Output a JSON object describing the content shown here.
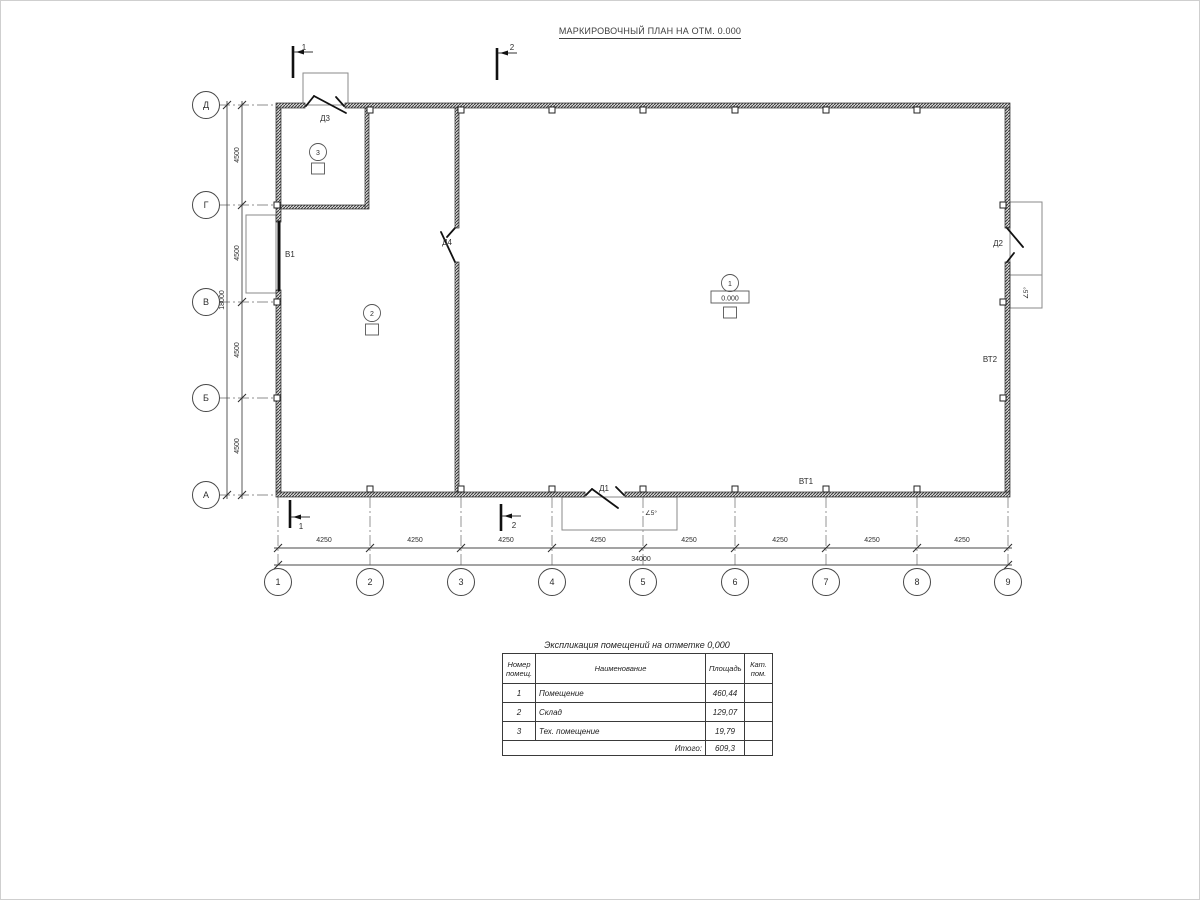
{
  "page": {
    "title": "МАРКИРОВОЧНЫЙ ПЛАН НА ОТМ. 0.000"
  },
  "plan": {
    "axes": {
      "rows": [
        "Д",
        "Г",
        "В",
        "Б",
        "А"
      ],
      "cols": [
        "1",
        "2",
        "3",
        "4",
        "5",
        "6",
        "7",
        "8",
        "9"
      ]
    },
    "dimensions": {
      "left_segments": [
        "4500",
        "4500",
        "4500",
        "4500"
      ],
      "left_total": "18000",
      "bottom_segments": [
        "4250",
        "4250",
        "4250",
        "4250",
        "4250",
        "4250",
        "4250",
        "4250"
      ],
      "bottom_total": "34000"
    },
    "sections": {
      "s1": "1",
      "s2": "2"
    },
    "doors": {
      "d1": "Д1",
      "d2": "Д2",
      "d3": "Д3",
      "d4": "Д4",
      "v1": "В1",
      "vt1": "ВТ1",
      "vt2": "ВТ2"
    },
    "slope_label": "∠5°",
    "rooms": [
      {
        "number": "1",
        "elevation": "0.000"
      },
      {
        "number": "2"
      },
      {
        "number": "3"
      }
    ]
  },
  "table": {
    "title": "Экспликация помещений на отметке 0,000",
    "headers": {
      "number_line1": "Номер",
      "number_line2": "помещ.",
      "name": "Наименование",
      "area": "Площадь",
      "category_line1": "Кат.",
      "category_line2": "пом."
    },
    "rows": [
      {
        "number": "1",
        "name": "Помещение",
        "area": "460,44"
      },
      {
        "number": "2",
        "name": "Склад",
        "area": "129,07"
      },
      {
        "number": "3",
        "name": "Тех. помещение",
        "area": "19,79"
      }
    ],
    "total_label": "Итого:",
    "total_value": "609,3"
  },
  "colors": {
    "line": "#3c3c3c",
    "wall": "#3f3f3f",
    "text": "#2e2e2e",
    "background": "#ffffff"
  }
}
